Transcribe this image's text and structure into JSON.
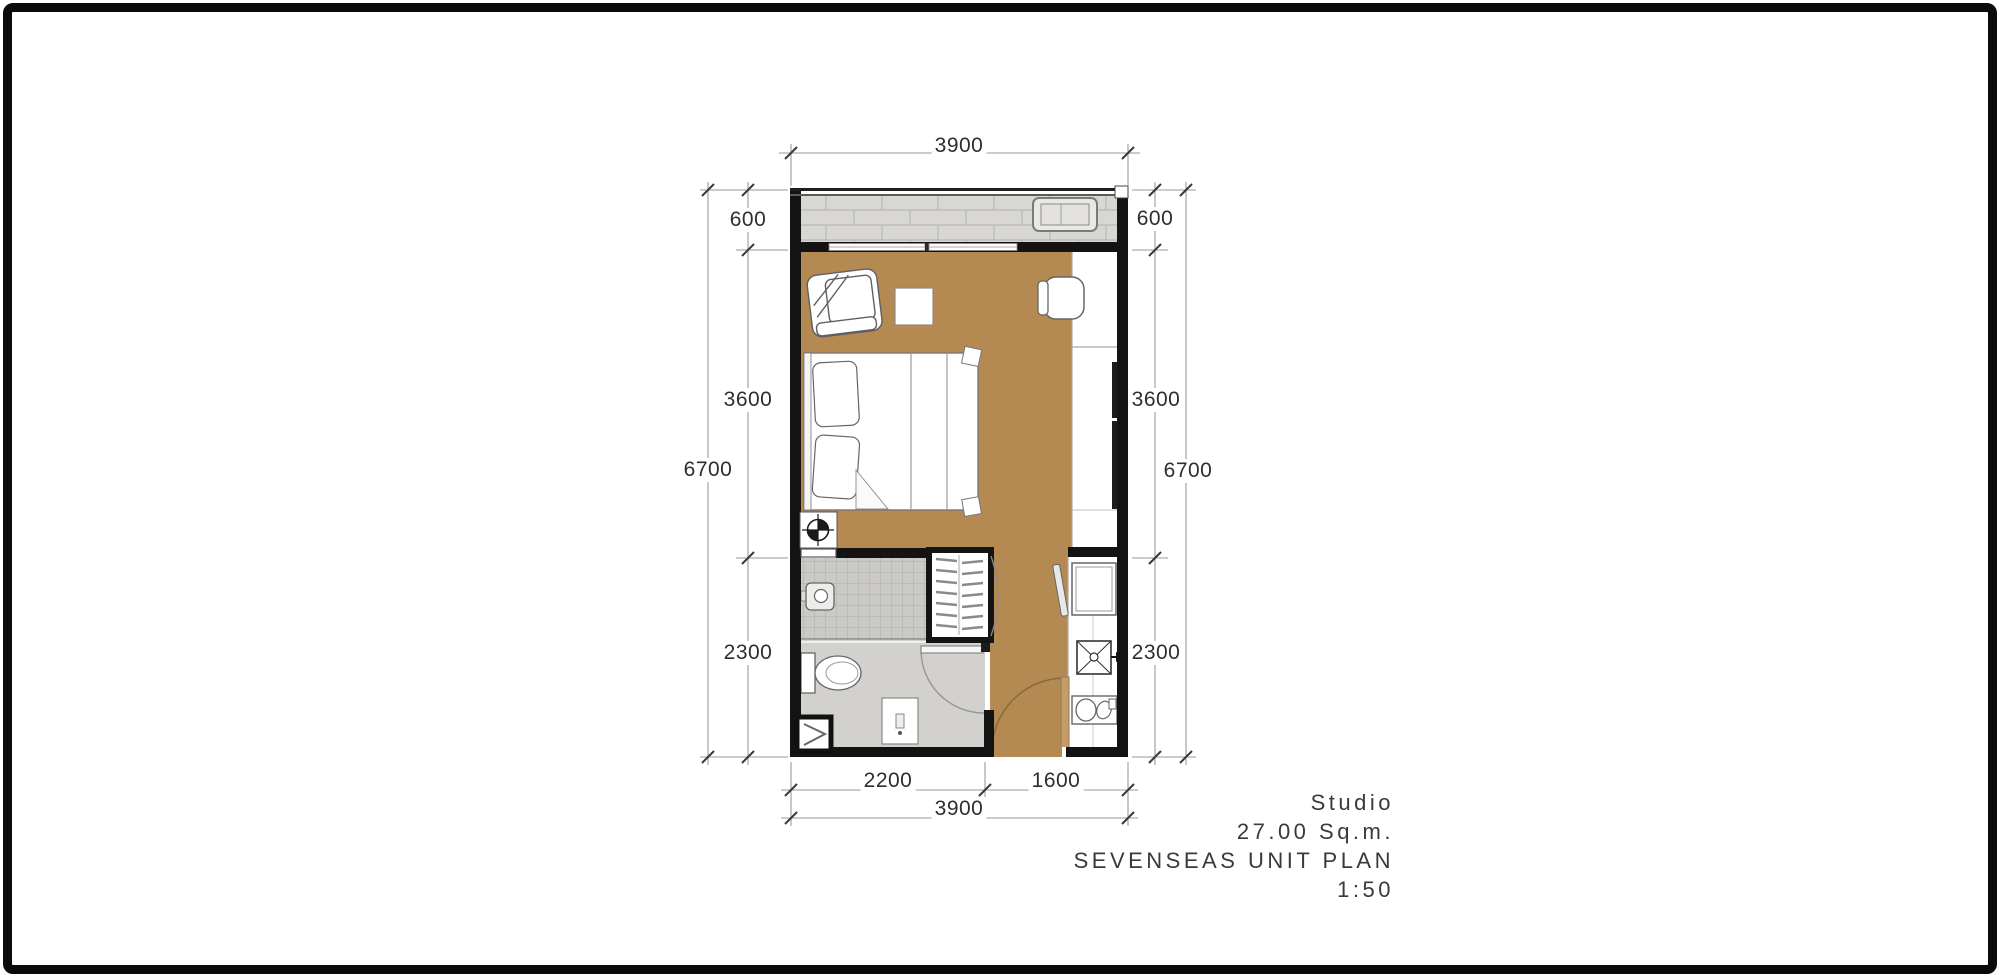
{
  "title_block": {
    "unit_type": "Studio",
    "area": "27.00 Sq.m.",
    "plan_name": "SEVENSEAS UNIT PLAN",
    "scale": "1:50"
  },
  "dimensions": {
    "top_width": "3900",
    "left": {
      "balcony": "600",
      "living": "3600",
      "bath": "2300",
      "total": "6700"
    },
    "right": {
      "balcony": "600",
      "living": "3600",
      "kitchen": "2300",
      "total": "6700"
    },
    "bottom": {
      "bath_width": "2200",
      "entry_width": "1600",
      "total": "3900"
    }
  },
  "colors": {
    "wall": "#131313",
    "floor_wood": "#b58a52",
    "balcony_tile": "#d8d7d4",
    "bath_tile": "#d2d1ce",
    "door_leaf": "#c59c66"
  }
}
